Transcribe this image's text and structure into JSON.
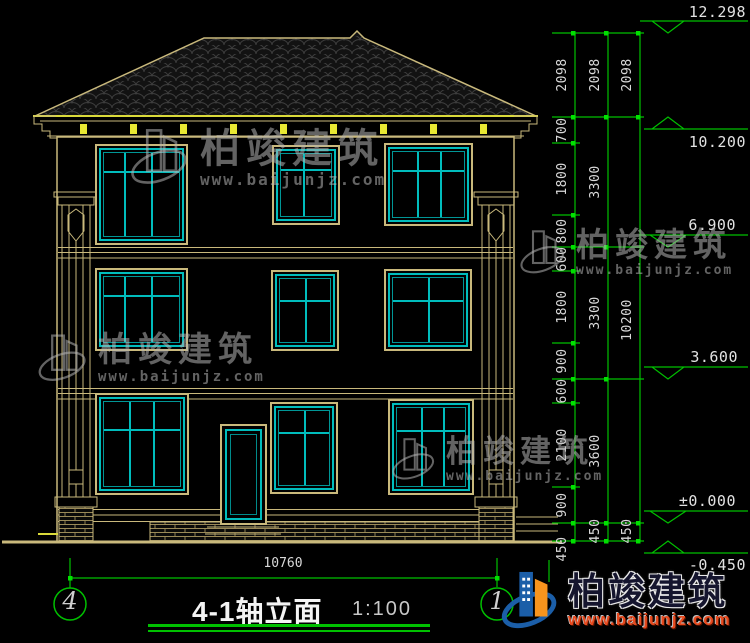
{
  "drawing": {
    "title": "4-1轴立面",
    "scale": "1:100",
    "axis_left": "4",
    "axis_right": "1",
    "bottom_width_dim": "10760"
  },
  "elevation_labels": [
    "12.298",
    "10.200",
    "6.900",
    "3.600",
    "±0.000",
    "-0.450"
  ],
  "dim_chain": {
    "col1": [
      "2098",
      "700",
      "1800",
      "800",
      "600",
      "1800",
      "900",
      "600",
      "2100",
      "900",
      "450"
    ],
    "col2": [
      "2098",
      "3300",
      "3300",
      "3600",
      "450"
    ],
    "col3": [
      "2098",
      "10200",
      "450"
    ]
  },
  "watermark": {
    "brand": "柏竣建筑",
    "url": "www.baijunjz.com"
  },
  "logo": {
    "brand": "柏竣建筑",
    "url": "www.baijunjz.com"
  },
  "colors": {
    "line_tan": "#C9B97C",
    "accent_yellow": "#E8E832",
    "window_teal": "#00BCBC",
    "dim_green": "#00C000",
    "logo_blue": "#1B5EA8",
    "logo_orange": "#F7941D",
    "logo_red": "#E8491D"
  }
}
